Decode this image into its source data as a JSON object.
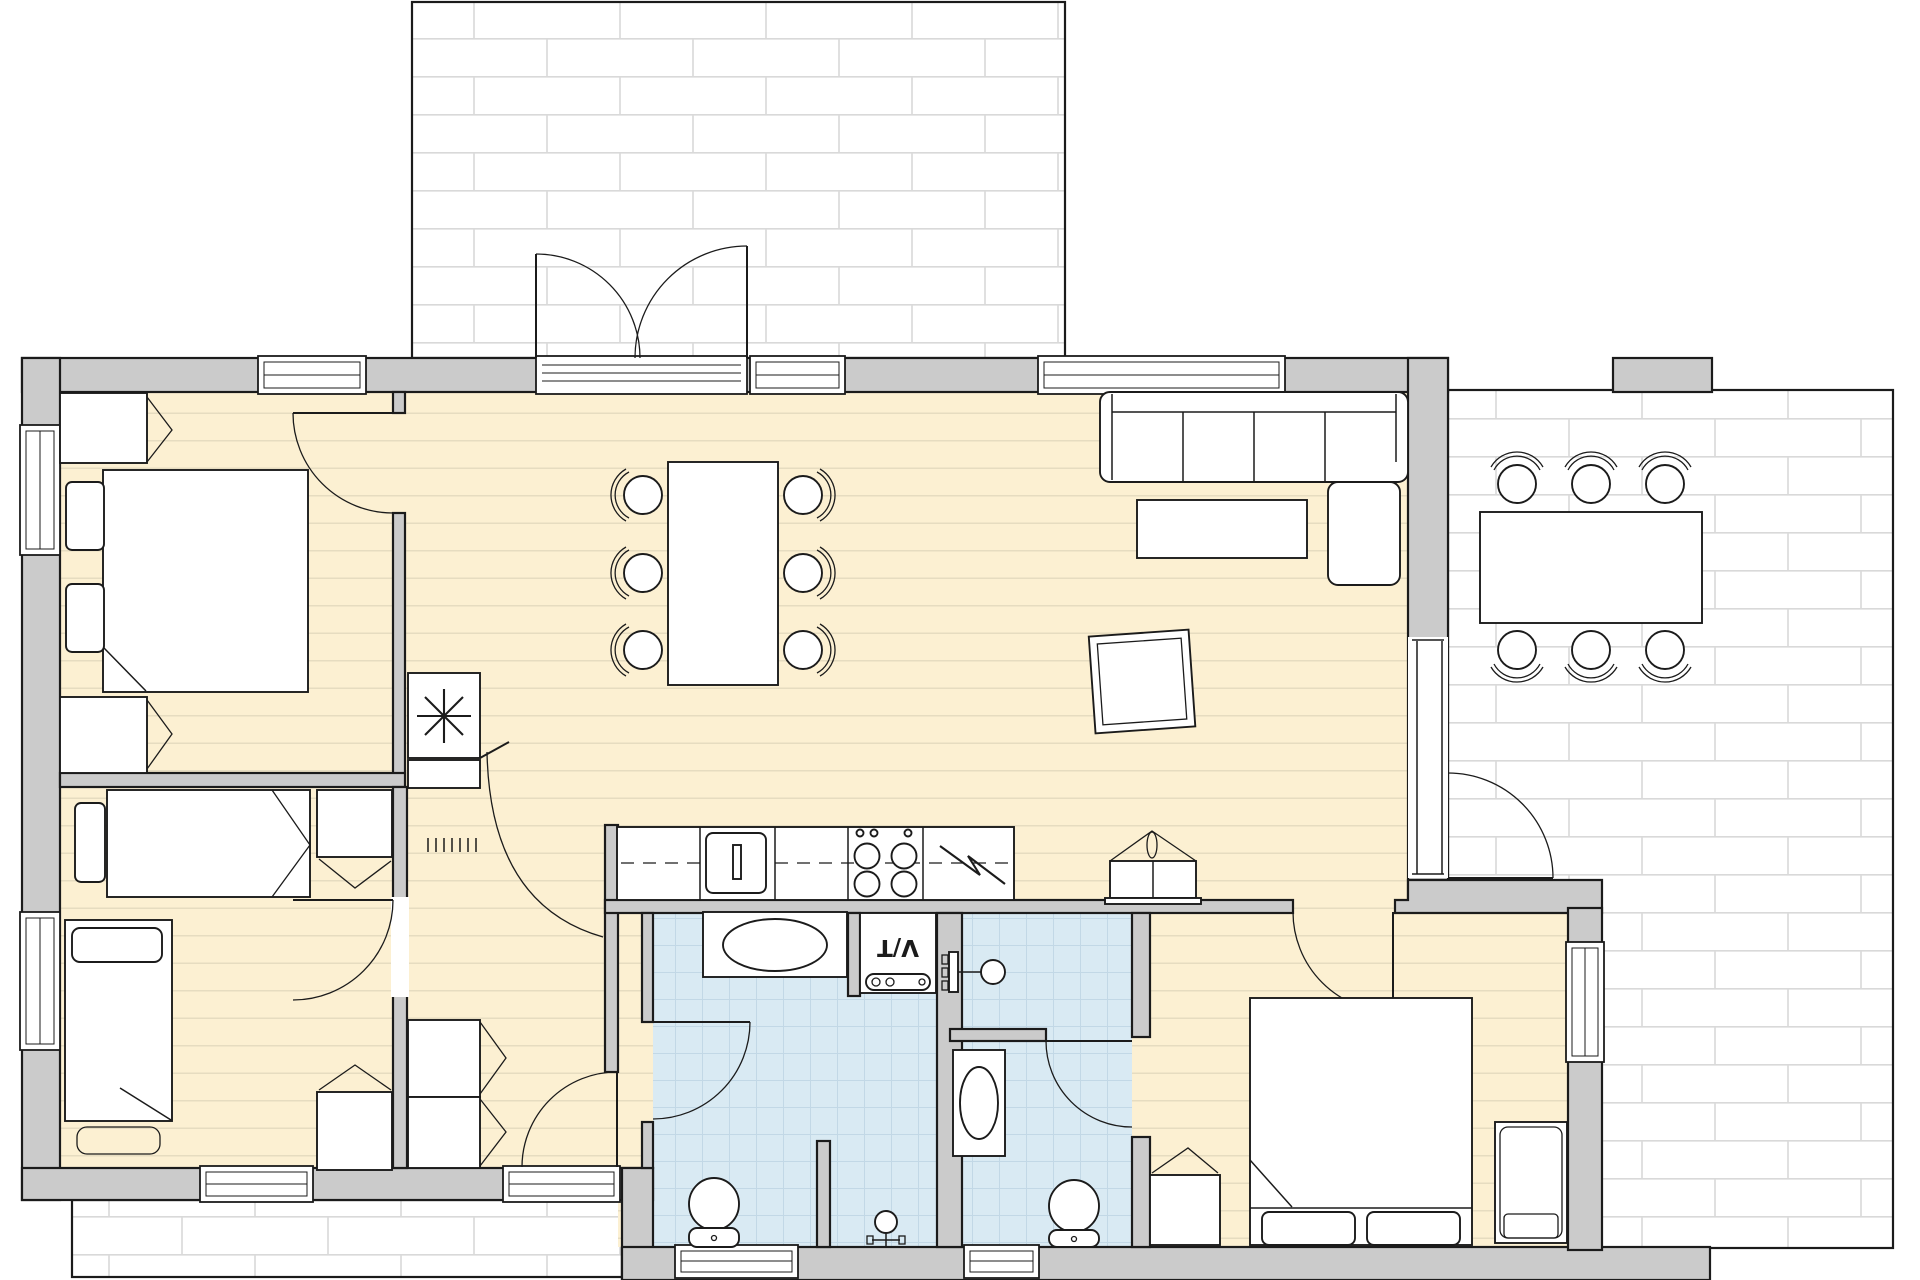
{
  "document": {
    "kind": "architectural floor plan",
    "view": "top-down 2D plan of a single-storey house with three outdoor paved areas"
  },
  "labels": {
    "washer_dryer": "V/T"
  },
  "colors": {
    "paper": "#ffffff",
    "wall-fill": "#cbcbcb",
    "outline": "#1b1b1b",
    "wood-floor": "#fcf0d2",
    "wood-line": "#e6dcc0",
    "tile-floor": "#d9eaf3",
    "tile-line": "#c2d8e6",
    "paving-line": "#d9d9d9",
    "furniture-fill": "#ffffff"
  },
  "rooms": [
    {
      "id": "living-room",
      "floor": "wood",
      "items": [
        "corner sofa with chaise",
        "coffee table",
        "tilted rug"
      ]
    },
    {
      "id": "dining-area",
      "floor": "wood",
      "items": [
        "dining table",
        "6 chairs"
      ]
    },
    {
      "id": "kitchen",
      "floor": "wood",
      "items": [
        "counter run",
        "sink with tap",
        "4-burner cooktop",
        "appliance with zigzag symbol"
      ]
    },
    {
      "id": "bedroom-north-west",
      "floor": "wood",
      "items": [
        "double bed",
        "2 pillows",
        "2 nightstands with open doors"
      ]
    },
    {
      "id": "bedroom-south-west",
      "floor": "wood",
      "items": [
        "single bed horizontal",
        "single bed vertical",
        "dresser",
        "desk",
        "bench"
      ]
    },
    {
      "id": "bedroom-south-east",
      "floor": "wood",
      "items": [
        "double bed",
        "2 pillows",
        "crib",
        "dresser"
      ]
    },
    {
      "id": "bathroom-large",
      "floor": "tile",
      "items": [
        "vanity with oval basin",
        "washer-dryer labelled V/T",
        "toilet",
        "shower tap",
        "shower partition"
      ]
    },
    {
      "id": "bathroom-small",
      "floor": "tile",
      "items": [
        "shower mixer",
        "wash basin",
        "toilet"
      ]
    },
    {
      "id": "hall",
      "floor": "wood",
      "items": [
        "2 closets with open doors",
        "wood-burning stove with asterisk symbol",
        "radiator grille",
        "lidded basket"
      ]
    }
  ],
  "outdoor_areas": [
    {
      "id": "patio-north",
      "surface": "brick paving",
      "items": [
        "double french doors opening out"
      ]
    },
    {
      "id": "terrace-east",
      "surface": "brick paving",
      "items": [
        "outdoor table",
        "6 chairs",
        "masonry pillar"
      ]
    },
    {
      "id": "patio-south-west",
      "surface": "brick paving",
      "items": []
    }
  ],
  "counts": {
    "doors": 9,
    "windows": 10
  }
}
